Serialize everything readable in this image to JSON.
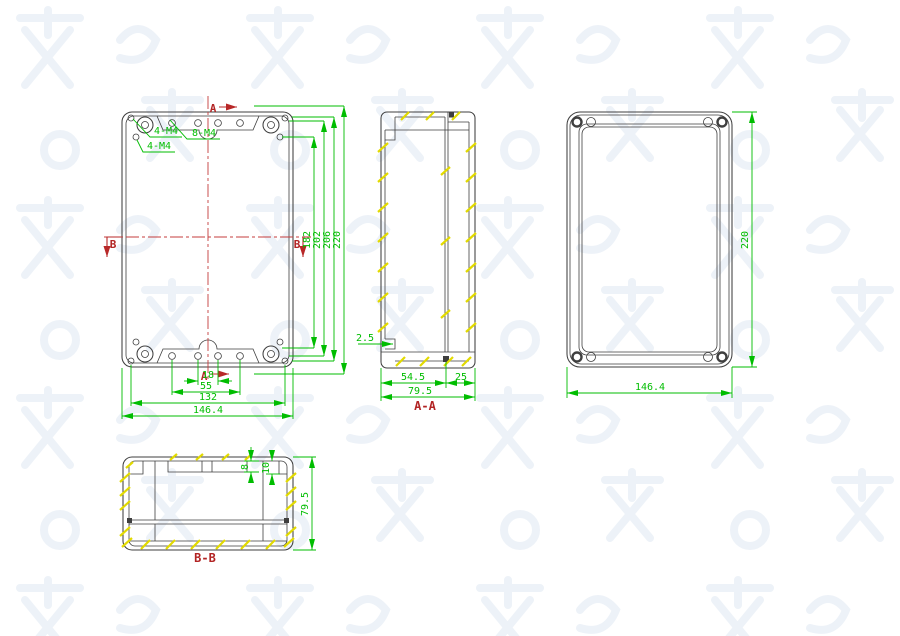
{
  "colors": {
    "drawing_line": "#3f3f3f",
    "dimension_green": "#00bd00",
    "centerline_red": "#c43c3c",
    "section_red": "#b22424",
    "hatch_yellow": "#e2da00",
    "watermark": "#edf2f8"
  },
  "front_view": {
    "labels": {
      "callout_corner_top": "4-M4",
      "callout_corner_inner": "4-M4",
      "callout_boss": "8-M4"
    },
    "markers": {
      "a_top": "A",
      "a_bottom": "A",
      "b_left": "B",
      "b_right": "B"
    },
    "dims": {
      "d18": "18",
      "d55": "55",
      "d132": "132",
      "d146_4": "146.4",
      "d182": "182",
      "d202": "202",
      "d206": "206",
      "d220": "220"
    }
  },
  "section_aa": {
    "title": "A-A",
    "dims": {
      "d2_5": "2.5",
      "d54_5": "54.5",
      "d25": "25",
      "d79_5": "79.5"
    }
  },
  "back_view": {
    "dims": {
      "d220": "220",
      "d146_4": "146.4"
    }
  },
  "section_bb": {
    "title": "B-B",
    "dims": {
      "d8": "8",
      "d10": "10",
      "d79_5": "79.5"
    }
  }
}
